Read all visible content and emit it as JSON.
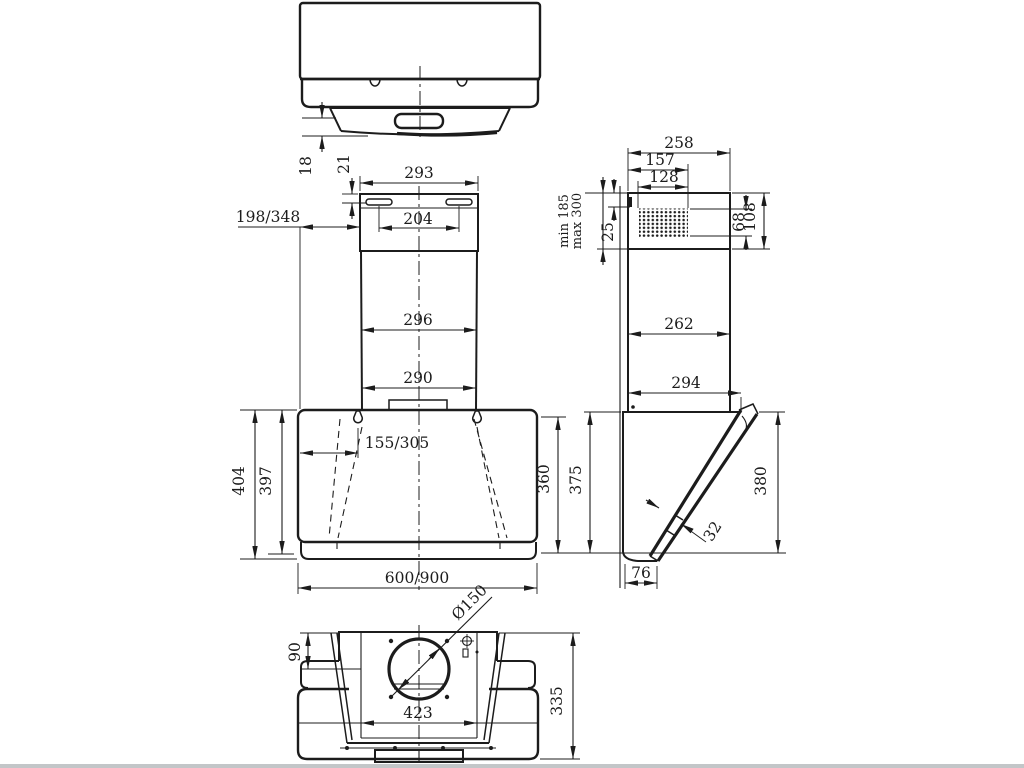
{
  "colors": {
    "line_color": "#1c1c1c",
    "background": "#ffffff",
    "footer_strip": "#c3c6c8"
  },
  "dimensions": {
    "top_view": {
      "offset_18": "18",
      "offset_21": "21"
    },
    "front_view": {
      "chimney_top_width": "293",
      "slot_spacing": "204",
      "wall_offset": "198/348",
      "chimney_mid_width": "296",
      "chimney_bottom_width": "290",
      "mount_hole_offset": "155/305",
      "body_height_total": "404",
      "body_height_front": "397",
      "right_height": "360",
      "body_width": "600/900"
    },
    "side_view": {
      "top_depth": "258",
      "vent_depth": "157",
      "grille_depth": "128",
      "telescopic_min": "min 185",
      "telescopic_max": "max 300",
      "slot_offset": "25",
      "grille_height": "68",
      "top_section_height": "108",
      "chimney_depth": "262",
      "body_depth": "294",
      "back_height": "375",
      "glass_height": "380",
      "glass_thickness": "32",
      "bottom_depth": "76"
    },
    "bottom_view": {
      "outlet_offset": "90",
      "outlet_diameter": "Ø150",
      "filter_width": "423",
      "body_depth": "335"
    }
  }
}
